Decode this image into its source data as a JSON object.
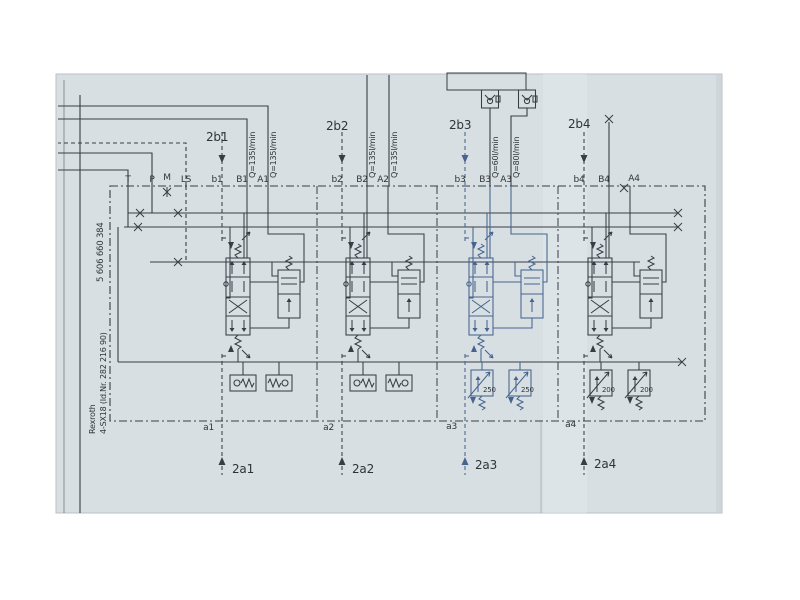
{
  "titleblock": {
    "part_number": "5 606 660 384",
    "brand": "Rexroth",
    "model": "4-SX18 (Id.Nr. 282 216 90)"
  },
  "ports": {
    "t": "T",
    "p": "P",
    "m": "M",
    "ls": "LS"
  },
  "sections": [
    {
      "pilot_top": "2b1",
      "port_pilot_b": "b1",
      "port_b": "B1",
      "port_a": "A1",
      "flow_b": "Q=135l/min",
      "flow_a": "Q=135l/min",
      "port_pilot_a": "a1",
      "pilot_bottom": "2a1"
    },
    {
      "pilot_top": "2b2",
      "port_pilot_b": "b2",
      "port_b": "B2",
      "port_a": "A2",
      "flow_b": "Q=135l/min",
      "flow_a": "Q=135l/min",
      "port_pilot_a": "a2",
      "pilot_bottom": "2a2"
    },
    {
      "pilot_top": "2b3",
      "port_pilot_b": "b3",
      "port_b": "B3",
      "port_a": "A3",
      "flow_b": "Q=60l/min",
      "flow_a": "Q=80l/min",
      "relief_b": "250",
      "relief_a": "250",
      "port_pilot_a": "a3",
      "pilot_bottom": "2a3"
    },
    {
      "pilot_top": "2b4",
      "port_pilot_b": "b4",
      "port_b": "B4",
      "port_a": "A4",
      "relief_b": "200",
      "relief_a": "200",
      "port_pilot_a": "a4",
      "pilot_bottom": "2a4"
    }
  ],
  "colors": {
    "paper": "#d8dfe3",
    "ink": "#383d44",
    "section3_ink": "#46648f"
  }
}
